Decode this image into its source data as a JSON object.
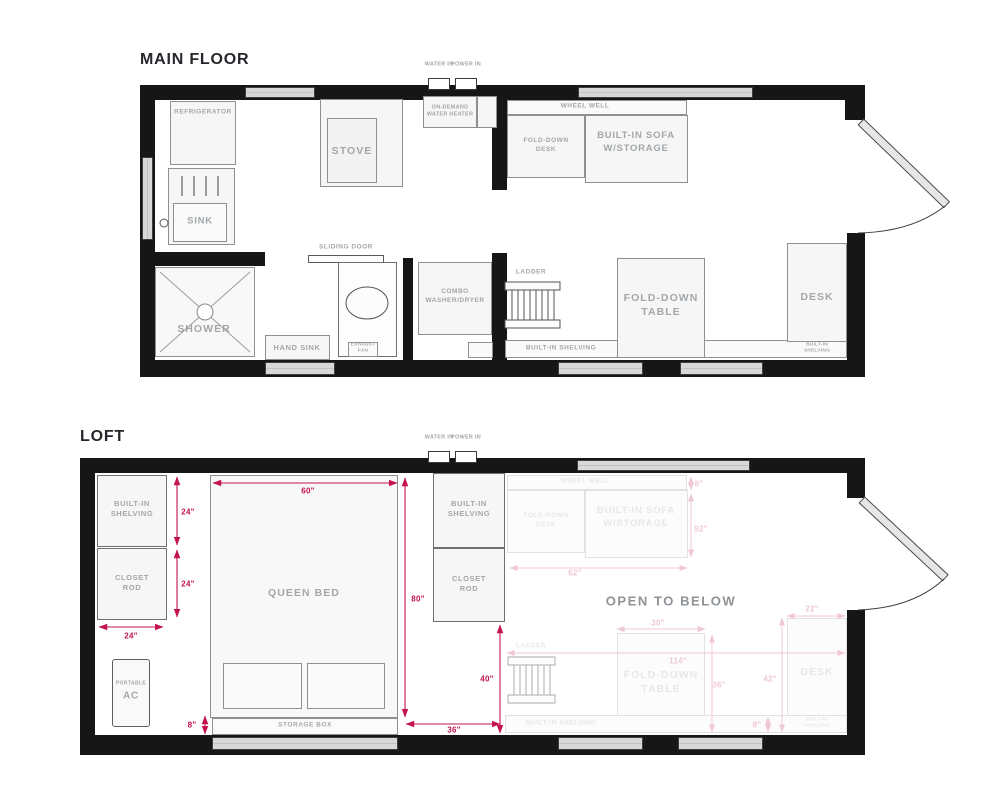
{
  "colors": {
    "wall": "#161616",
    "dimension_red": "#c31350",
    "label_gray": "#a2a7ab"
  },
  "main_floor": {
    "title": "MAIN FLOOR",
    "water_in": "WATER IN",
    "power_in": "POWER IN",
    "refrigerator": "REFRIGERATOR",
    "sink": "SINK",
    "stove": "STOVE",
    "water_heater": "ON-DEMAND WATER HEATER",
    "wheel_well": "WHEEL WELL",
    "fold_down_desk": "FOLD-DOWN DESK",
    "sofa": "BUILT-IN SOFA W/STORAGE",
    "shower": "SHOWER",
    "hand_sink": "HAND SINK",
    "sliding_door": "SLIDING DOOR",
    "toilet": "TOILET",
    "exhaust_fan": "EXHAUST FAN",
    "washer_dryer": "COMBO WASHER/DRYER",
    "ladder": "LADDER",
    "shelving": "BUILT-IN SHELVING",
    "fold_down_table": "FOLD-DOWN TABLE",
    "desk": "DESK",
    "desk_shelving": "BUILT-IN SHELVING"
  },
  "loft": {
    "title": "LOFT",
    "water_in": "WATER IN",
    "power_in": "POWER IN",
    "shelving_left": "BUILT-IN SHELVING",
    "closet_left": "CLOSET ROD",
    "queen_bed": "QUEEN BED",
    "storage_box": "STORAGE BOX",
    "ac_line1": "PORTABLE",
    "ac_line2": "AC",
    "shelving_center": "BUILT-IN SHELVING",
    "closet_center": "CLOSET ROD",
    "open_below": "OPEN TO BELOW",
    "dims": {
      "bed_width": "60\"",
      "bed_length": "80\"",
      "shelf_h": "24\"",
      "closet_h": "24\"",
      "closet_w": "24\"",
      "storage_h": "8\"",
      "walkway_h": "40\"",
      "walkway_w": "36\""
    },
    "ghost": {
      "wheel_well": "WHEEL WELL",
      "fold_down_desk": "FOLD-DOWN DESK",
      "sofa": "BUILT-IN SOFA W/STORAGE",
      "ladder": "LADDER",
      "fold_down_table": "FOLD-DOWN TABLE",
      "desk": "DESK",
      "shelving": "BUILT-IN SHELVING",
      "desk_shelving": "BUILT-IN SHELVING",
      "dims": {
        "wheel_h": "8\"",
        "sofa_len": "92\"",
        "sofa_w": "62\"",
        "table_w": "30\"",
        "open_len": "114\"",
        "table_h": "36\"",
        "desk_gap": "42\"",
        "desk_w": "22\"",
        "shelf_h": "8\""
      }
    }
  }
}
